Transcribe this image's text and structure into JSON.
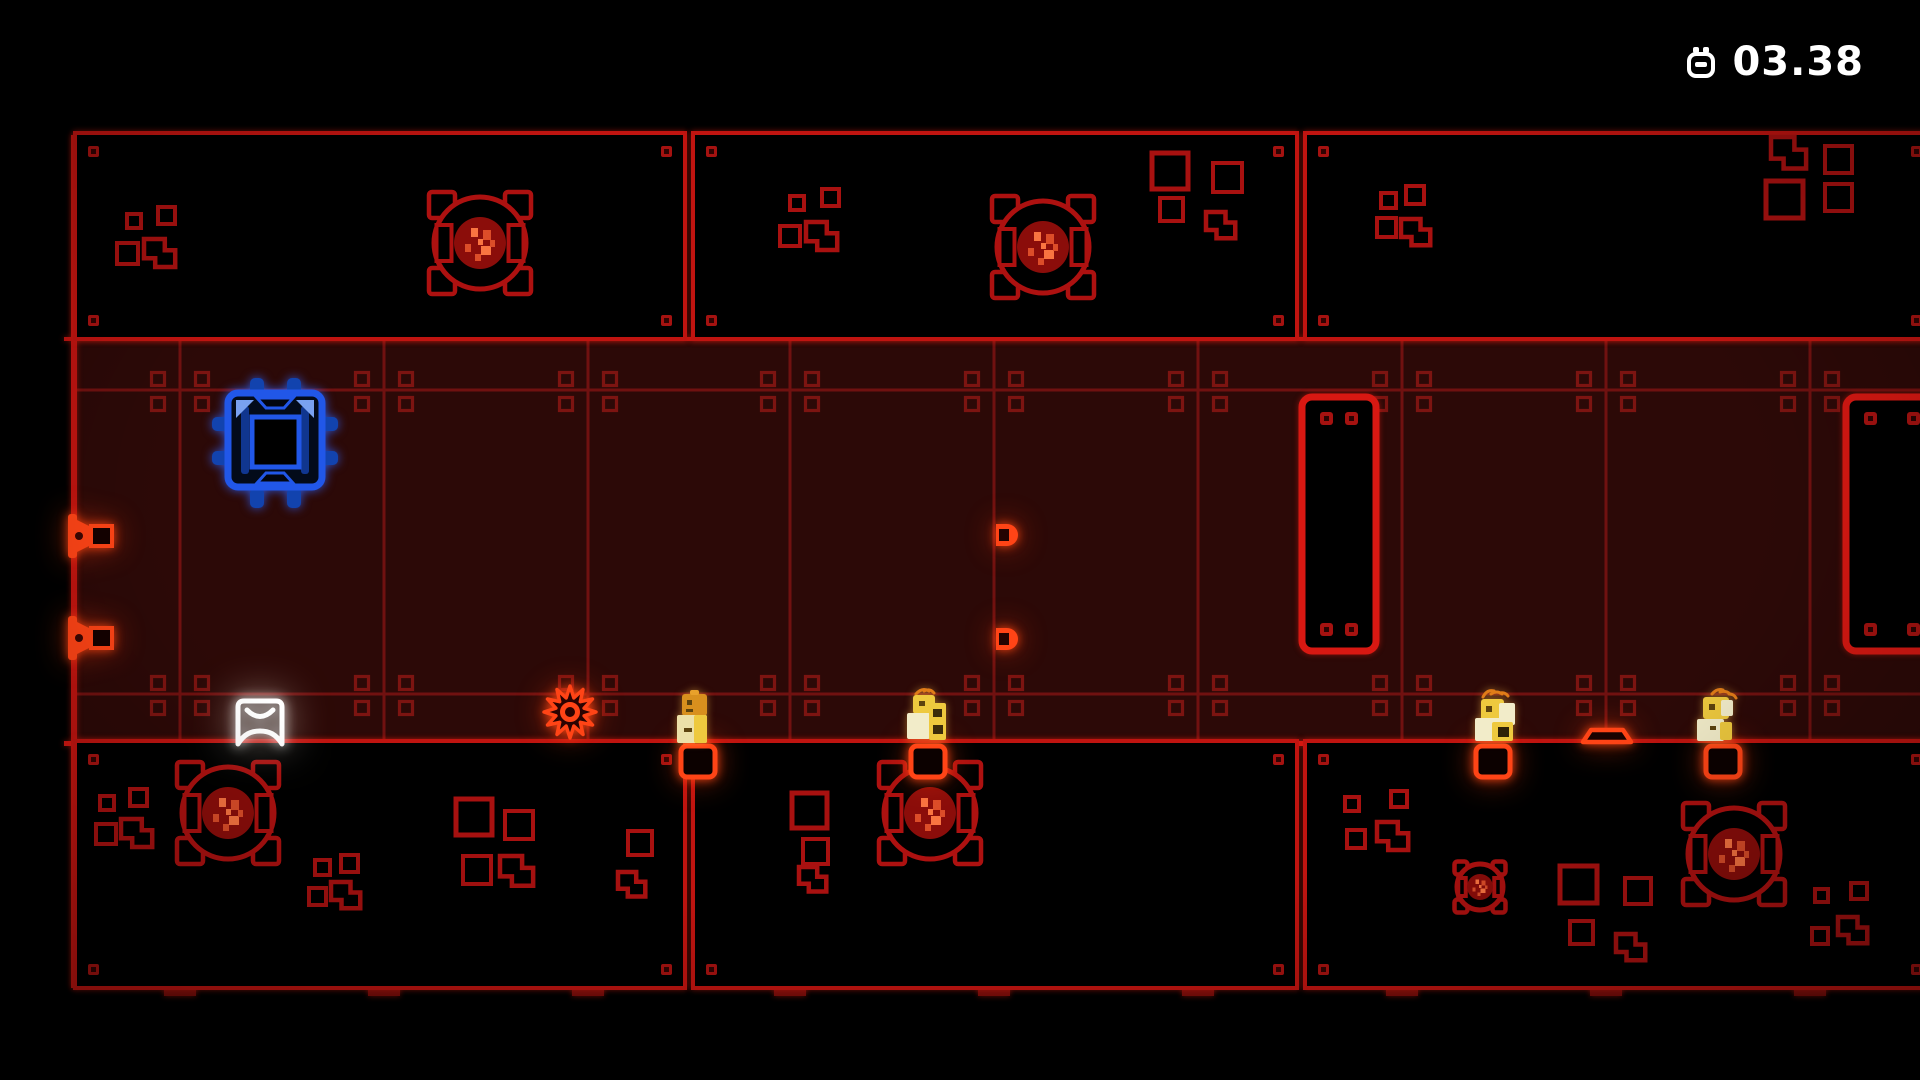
{
  "hud": {
    "timer": "03.38",
    "icon": "stopwatch"
  },
  "scene": {
    "colors": {
      "room": "#2c0907",
      "line_dim": "#701110",
      "bolt_dim": "#7c1411",
      "red": "#c01410",
      "floor": "#d41711",
      "door": "#d81812",
      "deco": "#a81110",
      "fan": "#ad1110",
      "disc": "#8b0d0a",
      "speck": "#e0512b",
      "bolt_fill": "#a51210",
      "orange": "#ff4416",
      "blue": "#2157e8",
      "yellow_pale": "#f2ecc9",
      "yellow_gold": "#eec93e",
      "head_orange": "#d8901e",
      "white": "#ffffff"
    },
    "grid": {
      "verticals": [
        180,
        384,
        588,
        790,
        994,
        1198,
        1402,
        1606,
        1810
      ],
      "wall_x": 74,
      "lines": {
        "top": 339,
        "upper": 390,
        "lower": 694,
        "floor": 743
      }
    },
    "doors": [
      {
        "x": 1302,
        "y": 397,
        "w": 74,
        "h": 254
      },
      {
        "x": 1846,
        "y": 397,
        "w": 92,
        "h": 254
      }
    ],
    "panels": [
      {
        "id": "top-left",
        "x": 75,
        "y": 133,
        "w": 610,
        "h": 206,
        "decor": [
          {
            "t": "sq",
            "x": 127,
            "y": 214,
            "s": 14
          },
          {
            "t": "sq",
            "x": 158,
            "y": 207,
            "s": 17
          },
          {
            "t": "sq",
            "x": 117,
            "y": 243,
            "s": 21
          },
          {
            "t": "L",
            "x": 144,
            "y": 239,
            "k": 0.8
          }
        ],
        "fans": [
          {
            "cx": 480,
            "cy": 243,
            "s": 1
          }
        ]
      },
      {
        "id": "top-middle",
        "x": 693,
        "y": 133,
        "w": 604,
        "h": 206,
        "decor": [
          {
            "t": "sq",
            "x": 790,
            "y": 196,
            "s": 14
          },
          {
            "t": "sq",
            "x": 822,
            "y": 189,
            "s": 17
          },
          {
            "t": "sq",
            "x": 780,
            "y": 226,
            "s": 20
          },
          {
            "t": "L",
            "x": 806,
            "y": 222,
            "k": 0.8
          },
          {
            "t": "sq",
            "x": 1152,
            "y": 153,
            "s": 36
          },
          {
            "t": "sq",
            "x": 1213,
            "y": 163,
            "s": 29
          },
          {
            "t": "sq",
            "x": 1160,
            "y": 198,
            "s": 23
          },
          {
            "t": "L",
            "x": 1206,
            "y": 212,
            "k": 0.75
          }
        ],
        "fans": [
          {
            "cx": 1043,
            "cy": 247,
            "s": 1
          }
        ]
      },
      {
        "id": "top-right",
        "x": 1305,
        "y": 133,
        "w": 630,
        "h": 206,
        "decor": [
          {
            "t": "sq",
            "x": 1381,
            "y": 193,
            "s": 15
          },
          {
            "t": "sq",
            "x": 1406,
            "y": 186,
            "s": 18
          },
          {
            "t": "sq",
            "x": 1377,
            "y": 218,
            "s": 19
          },
          {
            "t": "L",
            "x": 1401,
            "y": 219,
            "k": 0.75
          },
          {
            "t": "L",
            "x": 1771,
            "y": 137,
            "k": 0.9
          },
          {
            "t": "sq",
            "x": 1825,
            "y": 146,
            "s": 27
          },
          {
            "t": "sq",
            "x": 1766,
            "y": 181,
            "s": 37
          },
          {
            "t": "sq",
            "x": 1825,
            "y": 184,
            "s": 27
          }
        ],
        "fans": []
      },
      {
        "id": "bottom-left",
        "x": 75,
        "y": 741,
        "w": 610,
        "h": 247,
        "decor": [
          {
            "t": "sq",
            "x": 100,
            "y": 796,
            "s": 14
          },
          {
            "t": "sq",
            "x": 130,
            "y": 789,
            "s": 17
          },
          {
            "t": "sq",
            "x": 96,
            "y": 824,
            "s": 20
          },
          {
            "t": "L",
            "x": 121,
            "y": 819,
            "k": 0.8
          },
          {
            "t": "sq",
            "x": 315,
            "y": 860,
            "s": 15
          },
          {
            "t": "sq",
            "x": 341,
            "y": 855,
            "s": 17
          },
          {
            "t": "sq",
            "x": 309,
            "y": 888,
            "s": 17
          },
          {
            "t": "L",
            "x": 331,
            "y": 882,
            "k": 0.75
          },
          {
            "t": "sq",
            "x": 456,
            "y": 799,
            "s": 36
          },
          {
            "t": "sq",
            "x": 505,
            "y": 811,
            "s": 28
          },
          {
            "t": "sq",
            "x": 463,
            "y": 856,
            "s": 28
          },
          {
            "t": "L",
            "x": 500,
            "y": 856,
            "k": 0.85
          },
          {
            "t": "sq",
            "x": 628,
            "y": 831,
            "s": 24
          },
          {
            "t": "L",
            "x": 618,
            "y": 872,
            "k": 0.7
          }
        ],
        "fans": [
          {
            "cx": 228,
            "cy": 813,
            "s": 1
          }
        ]
      },
      {
        "id": "bottom-middle",
        "x": 693,
        "y": 741,
        "w": 604,
        "h": 247,
        "decor": [
          {
            "t": "sq",
            "x": 792,
            "y": 793,
            "s": 35
          },
          {
            "t": "sq",
            "x": 803,
            "y": 839,
            "s": 25
          },
          {
            "t": "L",
            "x": 799,
            "y": 867,
            "k": 0.7
          }
        ],
        "fans": [
          {
            "cx": 930,
            "cy": 813,
            "s": 1
          }
        ]
      },
      {
        "id": "bottom-right",
        "x": 1305,
        "y": 741,
        "w": 630,
        "h": 247,
        "decor": [
          {
            "t": "sq",
            "x": 1345,
            "y": 797,
            "s": 14
          },
          {
            "t": "sq",
            "x": 1391,
            "y": 791,
            "s": 16
          },
          {
            "t": "sq",
            "x": 1347,
            "y": 830,
            "s": 18
          },
          {
            "t": "L",
            "x": 1377,
            "y": 822,
            "k": 0.8
          },
          {
            "t": "sq",
            "x": 1560,
            "y": 866,
            "s": 37
          },
          {
            "t": "sq",
            "x": 1625,
            "y": 878,
            "s": 26
          },
          {
            "t": "sq",
            "x": 1570,
            "y": 921,
            "s": 23
          },
          {
            "t": "L",
            "x": 1616,
            "y": 934,
            "k": 0.75
          },
          {
            "t": "sq",
            "x": 1815,
            "y": 889,
            "s": 13
          },
          {
            "t": "sq",
            "x": 1851,
            "y": 883,
            "s": 16
          },
          {
            "t": "sq",
            "x": 1812,
            "y": 928,
            "s": 16
          },
          {
            "t": "L",
            "x": 1838,
            "y": 917,
            "k": 0.75
          }
        ],
        "fans": [
          {
            "cx": 1734,
            "cy": 854,
            "s": 1
          },
          {
            "cx": 1480,
            "cy": 887,
            "s": 0.5
          }
        ]
      }
    ],
    "entities": {
      "wall_emitters": [
        {
          "x": 70,
          "y": 536
        },
        {
          "x": 70,
          "y": 638
        }
      ],
      "line_emitters": [
        {
          "x": 996,
          "y": 535
        },
        {
          "x": 996,
          "y": 639
        }
      ],
      "saw": {
        "x": 570,
        "y": 712,
        "r": 26
      },
      "arcade_block": {
        "x": 260,
        "y": 722
      },
      "machine_block": {
        "x": 275,
        "y": 440
      },
      "platform": {
        "x": 1607,
        "y": 743
      },
      "hatches": [
        698,
        928,
        1493,
        1723
      ],
      "characters": [
        {
          "x": 694,
          "variant": 1
        },
        {
          "x": 925,
          "variant": 2
        },
        {
          "x": 1494,
          "variant": 3
        },
        {
          "x": 1720,
          "variant": 4
        }
      ]
    }
  }
}
